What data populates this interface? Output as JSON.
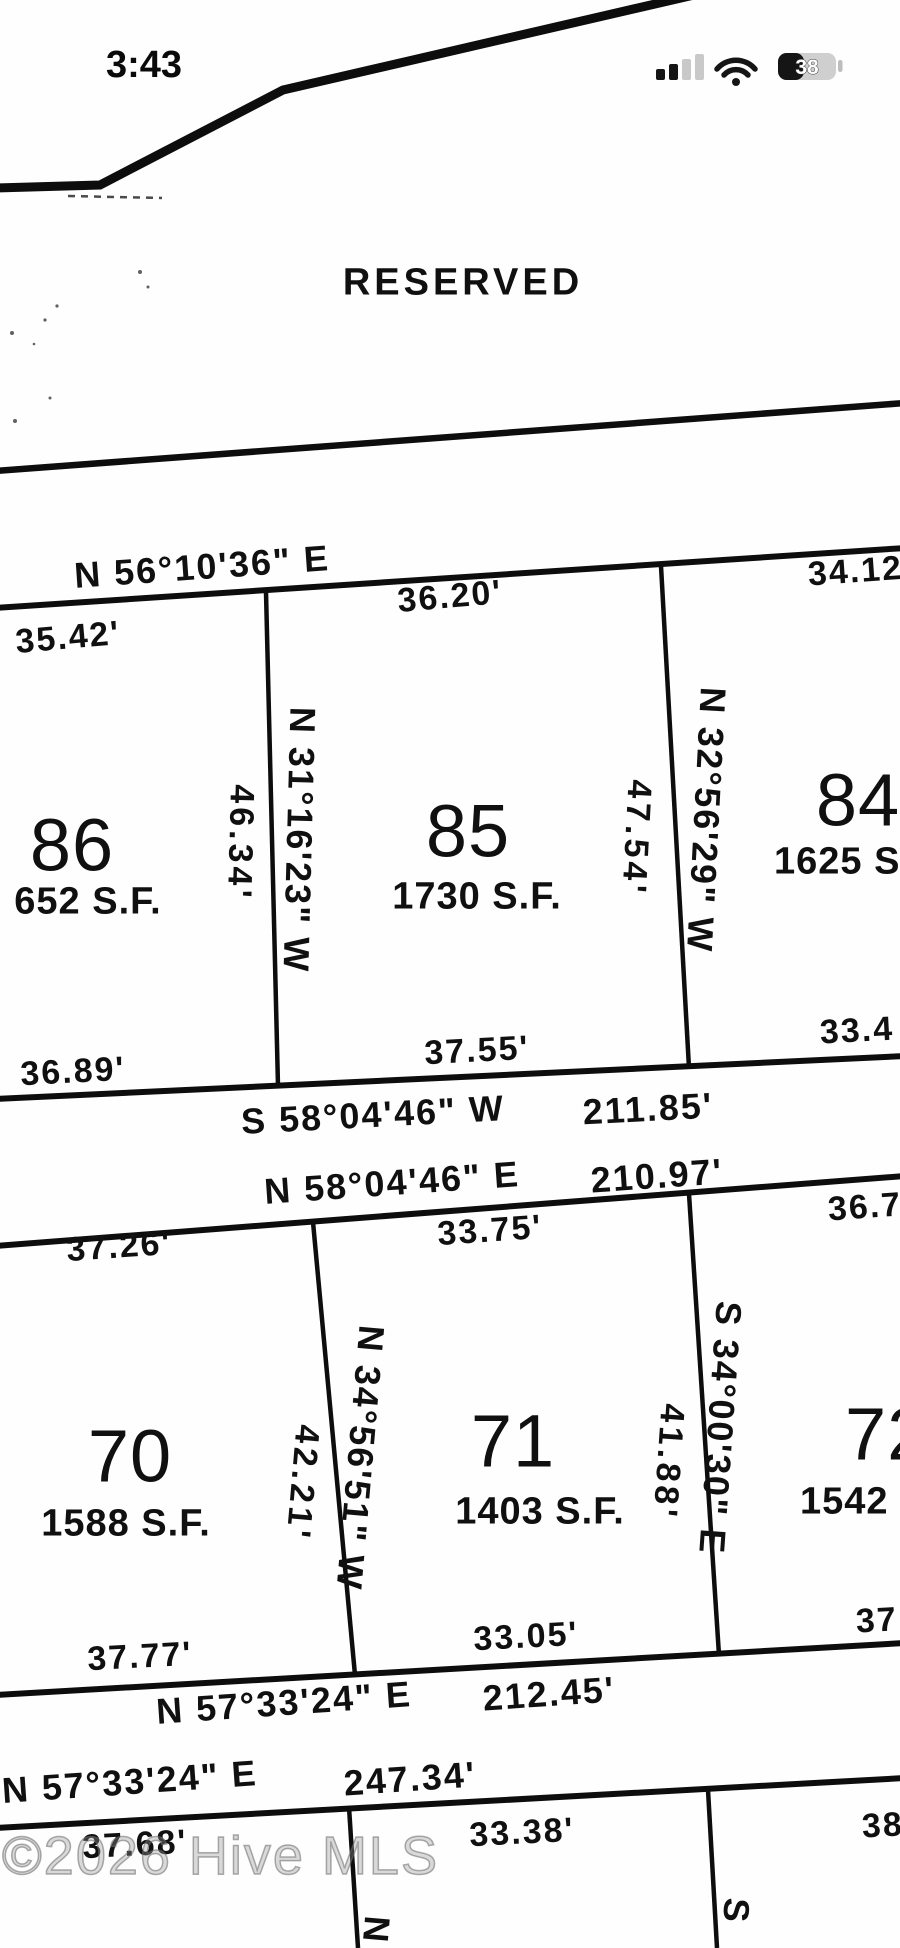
{
  "status_bar": {
    "time": "3:43",
    "battery_percent": "38"
  },
  "watermark": "©2026 Hive MLS",
  "plat": {
    "reserved": "RESERVED",
    "row1": {
      "street_bearing": "N 56°10'36\" E",
      "lot86": {
        "number": "86",
        "area": "652 S.F.",
        "front": "35.42'",
        "rear": "36.89'"
      },
      "lot85": {
        "number": "85",
        "area": "1730 S.F.",
        "front": "36.20'",
        "rear": "37.55'"
      },
      "lot84": {
        "number": "84",
        "area": "1625 S.",
        "front": "34.12'",
        "rear": "33.4"
      },
      "line_85_86": {
        "length": "46.34'",
        "bearing": "N 31°16'23\" W"
      },
      "line_84_85": {
        "length": "47.54'",
        "bearing": "N 32°56'29\" W"
      },
      "rear_bearing": "S 58°04'46\" W",
      "rear_distance": "211.85'"
    },
    "row2": {
      "street_bearing": "N 58°04'46\" E",
      "street_distance": "210.97'",
      "lot70": {
        "number": "70",
        "area": "1588 S.F.",
        "front": "37.26'",
        "rear": "37.77'"
      },
      "lot71": {
        "number": "71",
        "area": "1403 S.F.",
        "front": "33.75'",
        "rear": "33.05'"
      },
      "lot72": {
        "number": "72",
        "area": "1542",
        "front": "36.7",
        "rear": "37"
      },
      "line_70_71": {
        "length": "42.21'",
        "bearing": "N 34°56'51\" W"
      },
      "line_71_72": {
        "length": "41.88'",
        "bearing": "S 34°00'30\" E"
      },
      "rear_bearing": "N 57°33'24\" E",
      "rear_distance": "212.45'"
    },
    "row3": {
      "street_bearing": "N 57°33'24\" E",
      "street_distance": "247.34'",
      "left_dim": "37.68'",
      "mid_dim": "33.38'",
      "right_dim": "38",
      "left_line_char": "N",
      "right_line_char": "S"
    }
  }
}
